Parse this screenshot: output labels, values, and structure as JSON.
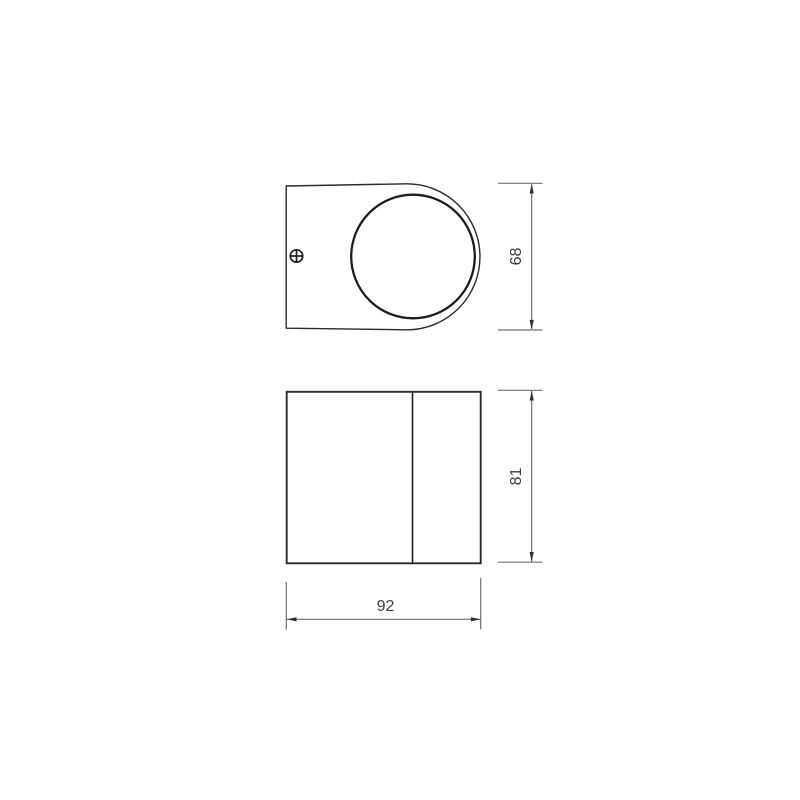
{
  "page": {
    "background": "#ffffff"
  },
  "drawing": {
    "kind": "product-dimension-diagram",
    "views": [
      {
        "id": "top-view",
        "features": [
          "outline",
          "lens-circle",
          "phillips-screw"
        ]
      },
      {
        "id": "side-view",
        "features": [
          "body-rectangle",
          "bezel-divider"
        ]
      }
    ],
    "icons": {
      "screw": "phillips-screw-icon",
      "arrows": [
        "arrow-up-icon",
        "arrow-down-icon",
        "arrow-left-icon",
        "arrow-right-icon"
      ]
    },
    "dimensions": {
      "top_height": {
        "label": "68"
      },
      "side_height": {
        "label": "81"
      },
      "width": {
        "label": "92"
      }
    },
    "colors": {
      "background": "#ffffff",
      "outline": "#2b2b2b",
      "detail": "#1c1c1c",
      "dimension": "#6f6f6f",
      "arrow": "#2e2e2e",
      "text": "#3c3c3c"
    }
  }
}
